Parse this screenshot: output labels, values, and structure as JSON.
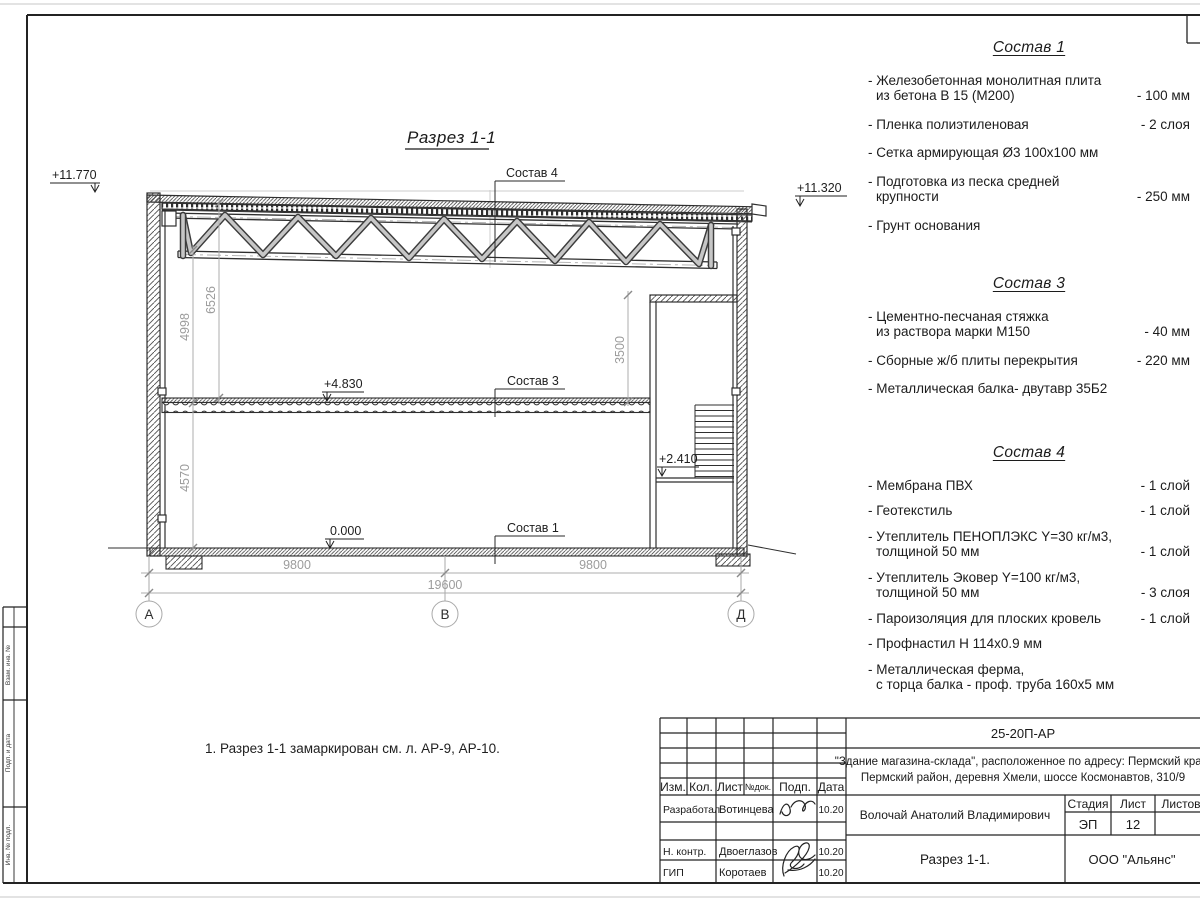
{
  "sheet": {
    "title": "Разрез 1-1",
    "note": "1. Разрез 1-1 замаркирован см. л. АР-9, АР-10.",
    "side_stamp": [
      "Взам. инв. №",
      "Подп. и дата",
      "Инв. № подл."
    ]
  },
  "drawing": {
    "elevations": {
      "roof_left": "+11.770",
      "roof_right": "+11.320",
      "floor2": "+4.830",
      "ground": "0.000",
      "landing": "+2.410"
    },
    "labels": {
      "layer4": "Состав 4",
      "layer3": "Состав 3",
      "layer1": "Состав 1"
    },
    "dimensions": {
      "v1": "4998",
      "v2": "6526",
      "v3": "4570",
      "v4": "3500",
      "h1": "9800",
      "h2": "9800",
      "total": "19600"
    },
    "axes": [
      "А",
      "В",
      "Д"
    ]
  },
  "specs": [
    {
      "title": "Состав 1",
      "items": [
        {
          "lines": [
            "- Железобетонная  монолитная плита",
            "из бетона В 15 (М200)"
          ],
          "value": "- 100 мм"
        },
        {
          "lines": [
            "- Пленка полиэтиленовая"
          ],
          "value": "-  2 слоя"
        },
        {
          "lines": [
            "- Сетка армирующая Ø3 100x100 мм"
          ],
          "value": ""
        },
        {
          "lines": [
            "- Подготовка из песка средней",
            "крупности"
          ],
          "value": "- 250 мм"
        },
        {
          "lines": [
            "- Грунт основания"
          ],
          "value": ""
        }
      ]
    },
    {
      "title": "Состав 3",
      "items": [
        {
          "lines": [
            "- Цементно-песчаная стяжка",
            "из раствора марки М150"
          ],
          "value": "- 40 мм"
        },
        {
          "lines": [
            "- Сборные ж/б плиты перекрытия"
          ],
          "value": "- 220 мм"
        },
        {
          "lines": [
            "- Металлическая балка- двутавр 35Б2"
          ],
          "value": ""
        }
      ]
    },
    {
      "title": "Состав 4",
      "items": [
        {
          "lines": [
            "- Мембрана ПВХ"
          ],
          "value": "- 1 слой"
        },
        {
          "lines": [
            "- Геотекстиль"
          ],
          "value": "- 1 слой"
        },
        {
          "lines": [
            "- Утеплитель ПЕНОПЛЭКС Y=30 кг/м3,",
            "толщиной 50 мм"
          ],
          "value": "- 1 слой"
        },
        {
          "lines": [
            "- Утеплитель Эковер Y=100 кг/м3,",
            "толщиной 50 мм"
          ],
          "value": "- 3 слоя"
        },
        {
          "lines": [
            "- Пароизоляция для плоских кровель"
          ],
          "value": "- 1 слой"
        },
        {
          "lines": [
            "- Профнастил Н 114x0.9 мм"
          ],
          "value": ""
        },
        {
          "lines": [
            "- Металлическая ферма,",
            "с торца балка - проф. труба 160x5 мм"
          ],
          "value": ""
        }
      ]
    }
  ],
  "title_block": {
    "doc_number": "25-20П-АР",
    "object_line1": "\"Здание магазина-склада\", расположенное по адресу: Пермский край,",
    "object_line2": "Пермский район, деревня Хмели, шоссе Космонавтов, 310/9",
    "columns": [
      "Изм.",
      "Кол.",
      "Лист",
      "№док.",
      "Подп.",
      "Дата"
    ],
    "rows": [
      {
        "role": "Разработал",
        "name": "Вотинцева",
        "date": "10.20"
      },
      {
        "role": "Н. контр.",
        "name": "Двоеглазов",
        "date": "10.20"
      },
      {
        "role": "ГИП",
        "name": "Коротаев",
        "date": "10.20"
      }
    ],
    "chief_name": "Волочай Анатолий Владимирович",
    "stage_label": "Стадия",
    "sheet_label": "Лист",
    "sheets_label": "Листов",
    "stage_value": "ЭП",
    "sheet_value": "12",
    "drawing_name": "Разрез 1-1.",
    "company": "ООО \"Альянс\""
  }
}
